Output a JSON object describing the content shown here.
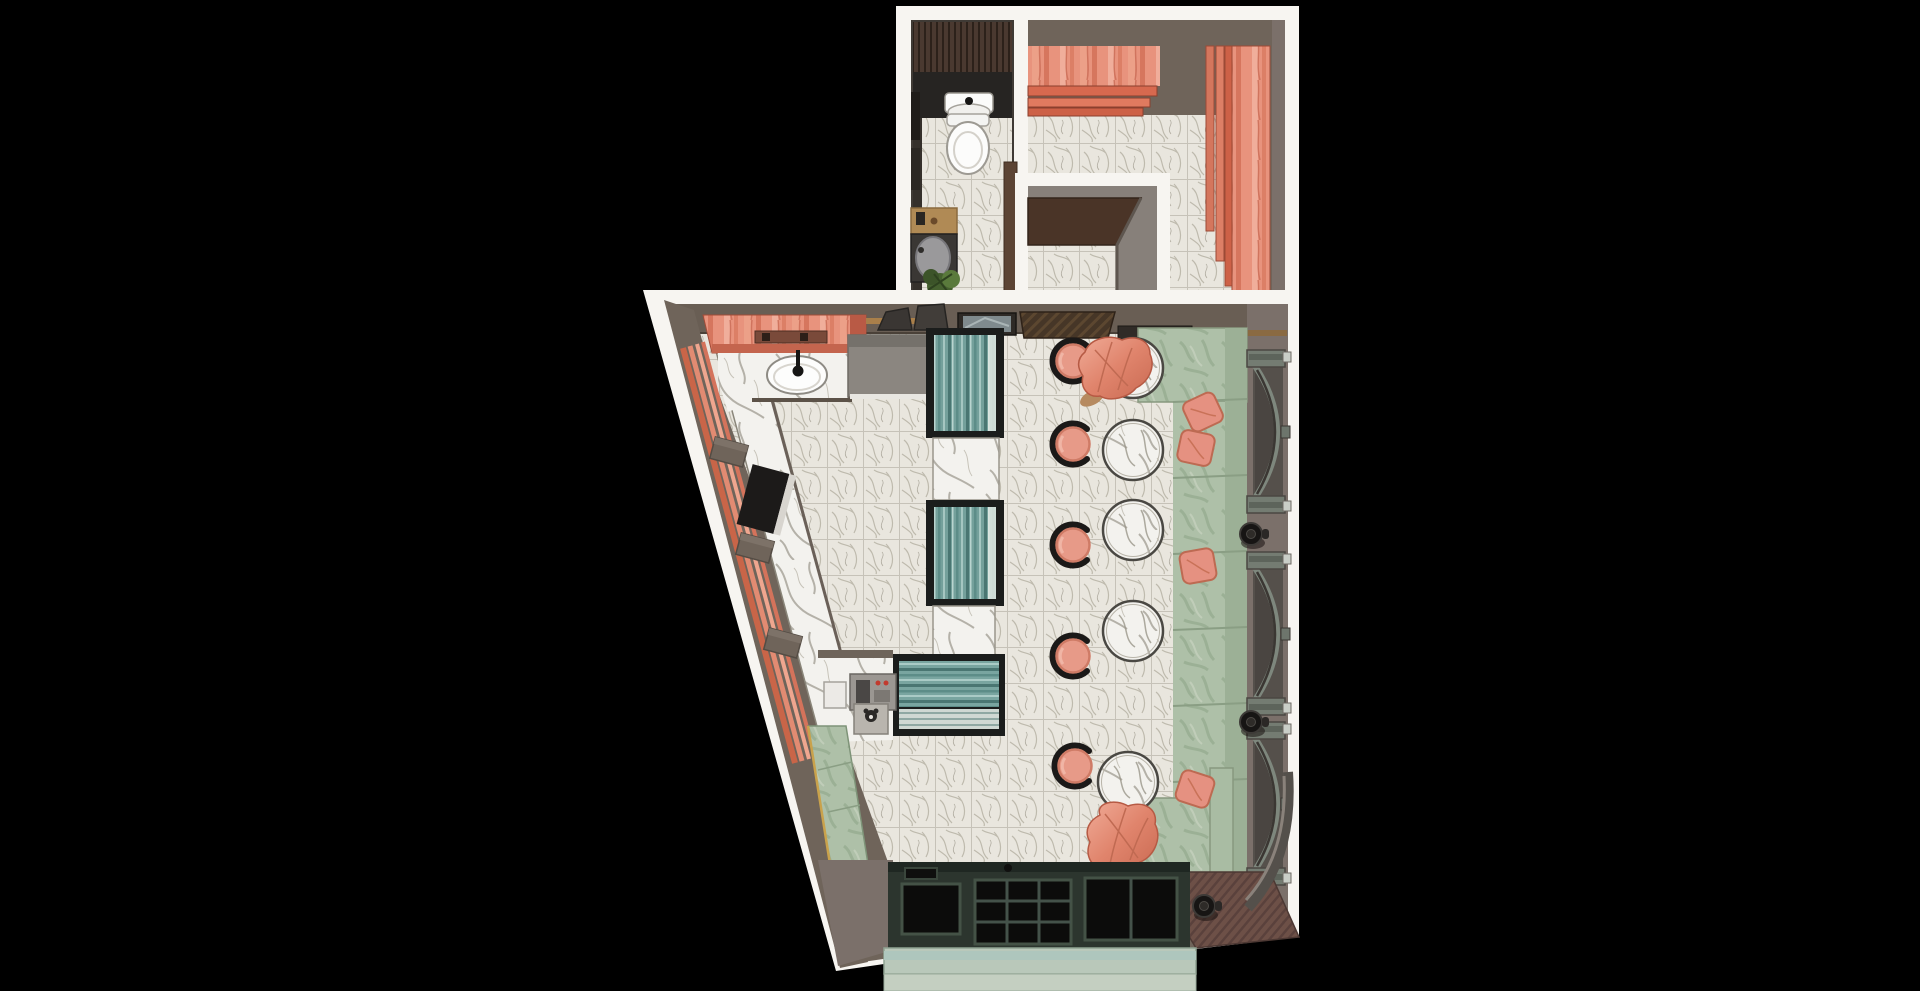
{
  "scene": {
    "title": "cafe-interior-top-view-render",
    "background": "#000000",
    "palette": {
      "frame": "#f7f5f1",
      "wall": "#6f645a",
      "wall2": "#7b706a",
      "wallTop": "#695e54",
      "woodDark": "#43322a",
      "blackZone": "#262422",
      "coral": "#e8937d",
      "coralDeep": "#c4654e",
      "teal": "#74a09b",
      "caseFrame": "#1b1d1c",
      "greenMarble": "#aec0a8",
      "greenMarbleB": "#9cb096",
      "mat": "#6d5047",
      "sill": "#b9c8ba",
      "winFrame": "#2c352e",
      "stoolPink": "#e79a88",
      "pillowPink": "#e59181",
      "drapePink": "#e0846c",
      "gold": "#c9a24c"
    },
    "rooms": [
      {
        "id": "bathroom",
        "label": "bathroom",
        "fixtures": [
          "wood-slat wall",
          "wall sink",
          "toilet",
          "wood vanity",
          "bathtub",
          "plant",
          "marble tile floor"
        ]
      },
      {
        "id": "entry-niche",
        "label": "entry niche",
        "fixtures": [
          "canopy",
          "marble tile floor"
        ]
      },
      {
        "id": "curtain-lounge",
        "label": "curtain lounge",
        "fixtures": [
          "pleated curtain top",
          "pleated curtain right",
          "marble tile floor"
        ]
      },
      {
        "id": "main-cafe",
        "label": "main cafe room",
        "fixtures": [
          "coral marble vanity with sink",
          "wall shelf with hats",
          "picture frames",
          "slatted awning",
          "two teal display cases",
          "marble service blocks",
          "teal pastry counter",
          "espresso machine",
          "cash register",
          "green marble bench",
          "window bay with steps",
          "green marble banquette",
          "fabric drapes",
          "entry mat",
          "curved corner wall"
        ]
      }
    ]
  },
  "furniture": {
    "stools": {
      "count": 5,
      "color": "#e79a88",
      "positions": [
        [
          1073,
          361
        ],
        [
          1073,
          444
        ],
        [
          1073,
          545
        ],
        [
          1073,
          656
        ],
        [
          1075,
          766
        ]
      ]
    },
    "tables": {
      "count": 5,
      "color": "#eceae4",
      "positions": [
        [
          1133,
          368
        ],
        [
          1133,
          450
        ],
        [
          1133,
          530
        ],
        [
          1133,
          631
        ],
        [
          1128,
          782
        ]
      ]
    },
    "arches": {
      "count": 3,
      "positions": [
        [
          1247,
          350
        ],
        [
          1247,
          552
        ],
        [
          1247,
          722
        ]
      ]
    },
    "knobs": {
      "count": 3,
      "positions": [
        [
          1251,
          534
        ],
        [
          1251,
          722
        ],
        [
          1204,
          906
        ]
      ]
    },
    "piers": {
      "count": 3,
      "rotation": 15,
      "positions": [
        [
          729,
          452
        ],
        [
          755,
          548
        ],
        [
          783,
          643
        ]
      ]
    },
    "pillows": {
      "count": 4,
      "positions": [
        [
          1203,
          412,
          -25
        ],
        [
          1196,
          448,
          12
        ],
        [
          1198,
          566,
          -10
        ],
        [
          1195,
          789,
          18
        ]
      ]
    },
    "banquette_joints": {
      "ys": [
        402,
        478,
        554,
        630,
        706,
        782
      ]
    }
  }
}
